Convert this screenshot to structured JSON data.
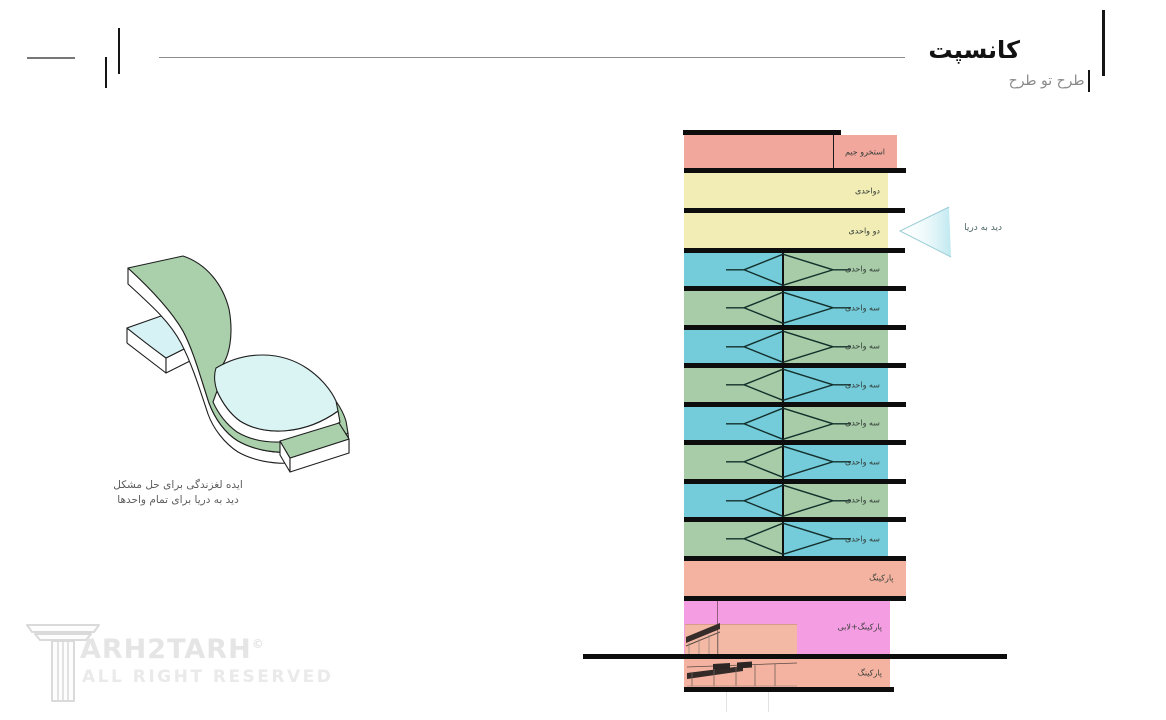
{
  "header": {
    "title": "کانسپت",
    "subtitle": "طرح تو طرح"
  },
  "concept": {
    "caption_line1": "ایده لغزندگی برای حل مشکل",
    "caption_line2": "دید به دریا برای تمام واحدها"
  },
  "arrow": {
    "label": "دید به دریا"
  },
  "building": {
    "floors": [
      {
        "kind": "pool",
        "label": "استخرو جیم"
      },
      {
        "kind": "two",
        "label": "دواحدی"
      },
      {
        "kind": "two",
        "label": "دو واحدی"
      },
      {
        "kind": "three",
        "label": "سه واحدی"
      },
      {
        "kind": "three",
        "label": "سه واحدی"
      },
      {
        "kind": "three",
        "label": "سه واحدی"
      },
      {
        "kind": "three",
        "label": "سه واحدی"
      },
      {
        "kind": "three",
        "label": "سه واحدی"
      },
      {
        "kind": "three",
        "label": "سه واحدی"
      },
      {
        "kind": "three",
        "label": "سه واحدی"
      },
      {
        "kind": "three",
        "label": "سه واحدی"
      },
      {
        "kind": "parking",
        "label": "پارکینگ"
      },
      {
        "kind": "lobby",
        "label": "پارکینگ+لابی"
      },
      {
        "kind": "basement",
        "label": "پارکینگ"
      }
    ]
  },
  "watermark": {
    "brand": "ARH2TARH",
    "copyright": "©",
    "rights": "ALL RIGHT RESERVED"
  },
  "colors": {
    "salmon": "#f2a79c",
    "salmon_parking": "#f4b3a0",
    "salmon_inset": "#f4b9a4",
    "yellow": "#f2edb4",
    "blue": "#74cbda",
    "green": "#a7cca7",
    "pink": "#f59de2",
    "slab": "#0d0d0d",
    "figure_green": "#a9d0ab",
    "figure_cyan": "#d9f4f3",
    "arrow_fill": "#bfe9f0"
  }
}
